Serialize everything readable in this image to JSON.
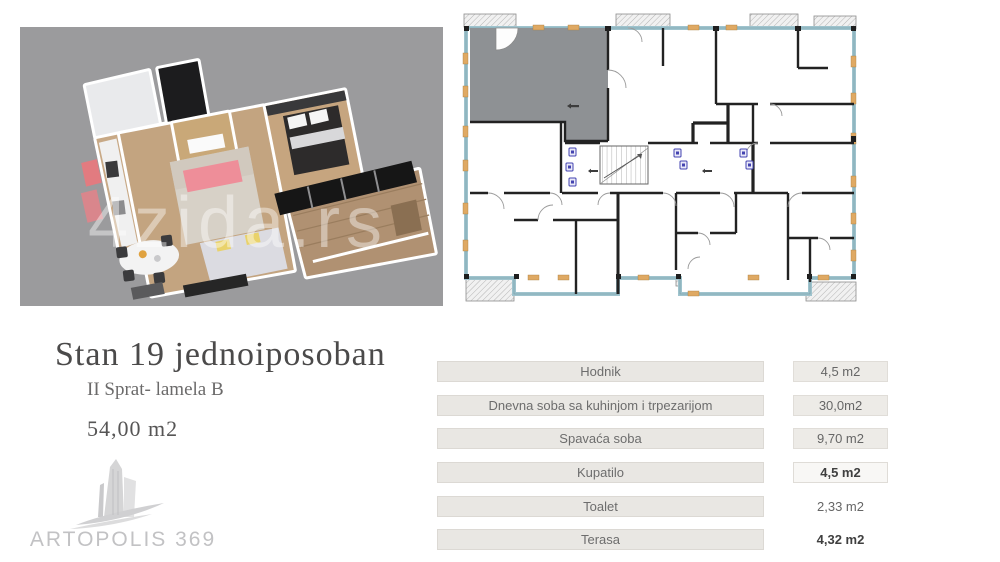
{
  "listing": {
    "title": "Stan 19 jednoiposoban",
    "subtitle": "II Sprat- lamela B",
    "total_area": "54,00 m2",
    "brand_name": "ARTOPOLIS 369",
    "watermark": "4zida.rs"
  },
  "rooms_table": {
    "rows": [
      {
        "label": "Hodnik",
        "value": "4,5 m2"
      },
      {
        "label": "Dnevna soba sa kuhinjom i trpezarijom",
        "value": "30,0m2"
      },
      {
        "label": "Spavaća soba",
        "value": "9,70 m2"
      },
      {
        "label": "Kupatilo",
        "value": "4,5 m2"
      },
      {
        "label": "Toalet",
        "value": "2,33 m2"
      },
      {
        "label": "Terasa",
        "value": "4,32 m2"
      }
    ]
  },
  "floor_plan_2d": {
    "highlighted_unit": "Stan 19",
    "highlight_color": "#8e9194",
    "window_color": "#9fc3cd",
    "frame_accent_color": "#dfa963"
  },
  "colors": {
    "plan3d_background": "#9b9b9d",
    "pink_accent": "#ee8e99",
    "wood_floor": "#c3a480",
    "row_box_fill": "#e9e7e3",
    "brand_gray": "#c2c2c4"
  }
}
